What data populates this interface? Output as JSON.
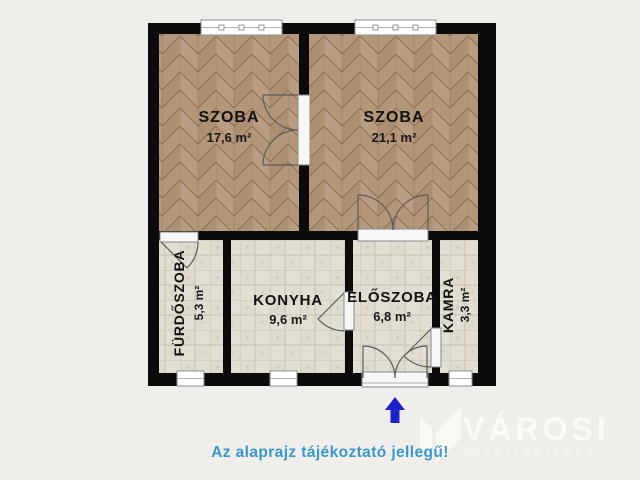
{
  "plan": {
    "rooms": [
      {
        "name": "SZOBA",
        "area": "17,6 m²",
        "floor": "parquet"
      },
      {
        "name": "SZOBA",
        "area": "21,1 m²",
        "floor": "parquet"
      },
      {
        "name": "FÜRDŐSZOBA",
        "area": "5,3 m²",
        "floor": "tile"
      },
      {
        "name": "KONYHA",
        "area": "9,6 m²",
        "floor": "tile"
      },
      {
        "name": "ELŐSZOBA",
        "area": "6,8 m²",
        "floor": "tile"
      },
      {
        "name": "KAMRA",
        "area": "3,3 m²",
        "floor": "tile"
      }
    ],
    "wall_color": "#0b0b0b",
    "parquet_color": "#b49678",
    "tile_color": "#e2ded3",
    "background_color": "#efeeea"
  },
  "entrance": {
    "arrow_direction": "up",
    "arrow_color": "#1c21cd"
  },
  "footer": {
    "disclaimer": "Az alaprajz tájékoztató jellegű!",
    "color": "#3a98cb"
  },
  "logo": {
    "title": "VÁROSI",
    "subtitle": "INGATLANIRODA",
    "color": "#fcfbf6"
  }
}
